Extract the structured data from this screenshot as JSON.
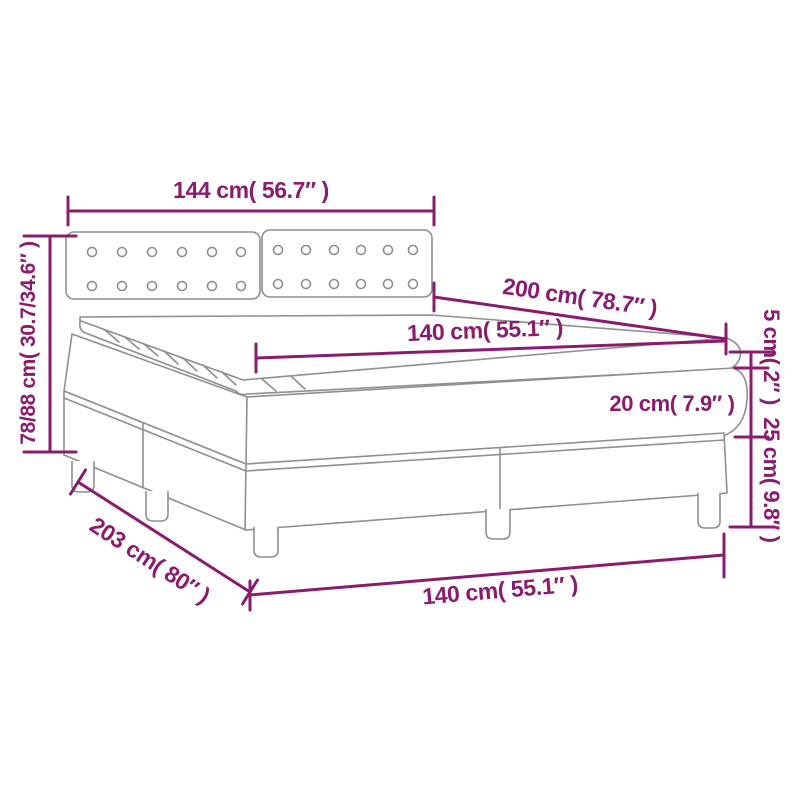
{
  "title": "Box spring bed with topper dimension diagram",
  "colors": {
    "dimension_accent": "#8a1c6f",
    "line_art": "#8f8f8f",
    "background": "#ffffff"
  },
  "labels": {
    "headboard_width": "144 cm( 56.7″ )",
    "bed_length": "200 cm( 78.7″ )",
    "mattress_width": "140 cm( 55.1″ )",
    "topper_height": "5 cm( 2″ )",
    "mattress_height": "20 cm( 7.9″ )",
    "base_height": "25 cm( 9.8″ )",
    "total_height": "78/88 cm( 30.7/34.6″ )",
    "total_length": "203 cm( 80″ )",
    "base_width": "140 cm( 55.1″ )"
  }
}
